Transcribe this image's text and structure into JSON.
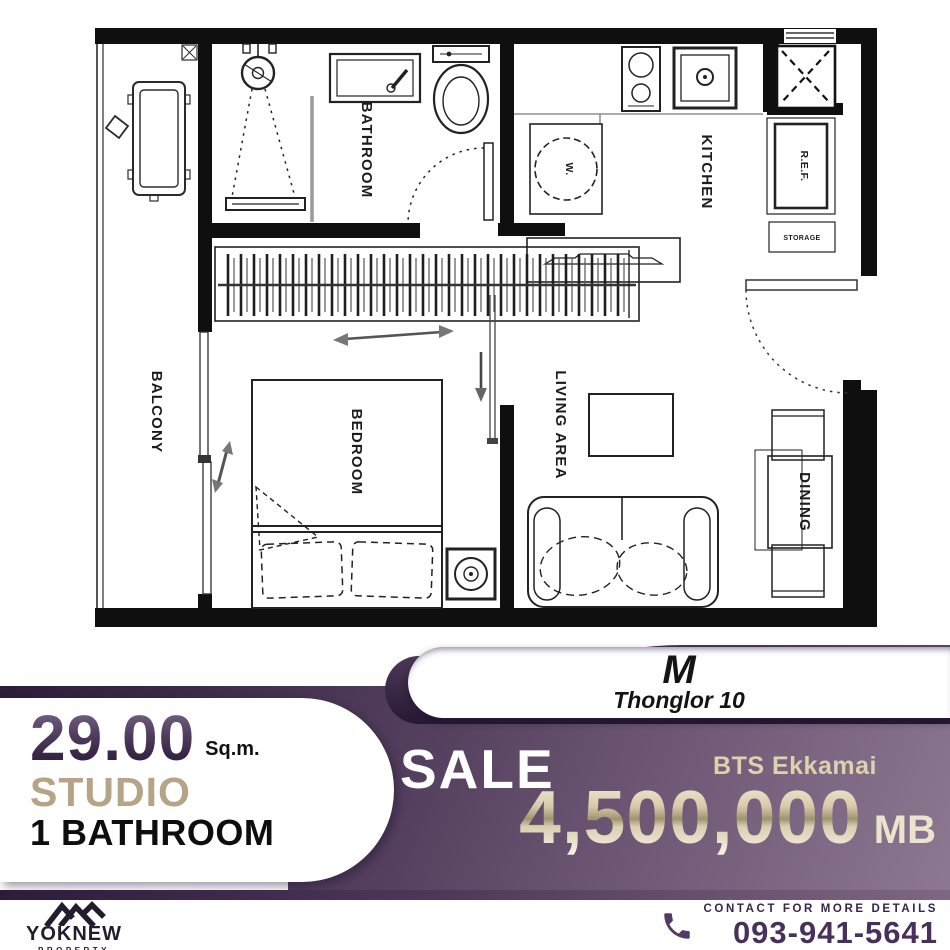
{
  "floor_plan": {
    "room_labels": {
      "balcony": "BALCONY",
      "bathroom": "BATHROOM",
      "kitchen": "KITCHEN",
      "bedroom": "BEDROOM",
      "living_area": "LIVING AREA",
      "dining": "DINING"
    },
    "fixture_labels": {
      "refrigerator": "R.E.F.",
      "storage": "STORAGE",
      "washer": "W."
    }
  },
  "unit_card": {
    "model": "M",
    "project": "Thonglor 10"
  },
  "specs": {
    "area_value": "29.00",
    "area_unit": "Sq.m.",
    "layout_type": "STUDIO",
    "bathroom_count": "1 BATHROOM"
  },
  "offer": {
    "listing_type": "SALE",
    "transit": "BTS Ekkamai",
    "price": "4,500,000",
    "price_unit": "MB"
  },
  "footer": {
    "brand": "YOKNEW",
    "brand_tagline": "PROPERTY",
    "contact_label": "CONTACT FOR MORE DETAILS",
    "phone": "093-941-5641"
  },
  "colors": {
    "banner_dark": "#2e1d3a",
    "banner_light": "#8d7892",
    "accent_tan": "#b5a586",
    "price_gold": "#d8cbac",
    "brand_purple": "#241b2e",
    "wall_black": "#0f0f0f"
  }
}
